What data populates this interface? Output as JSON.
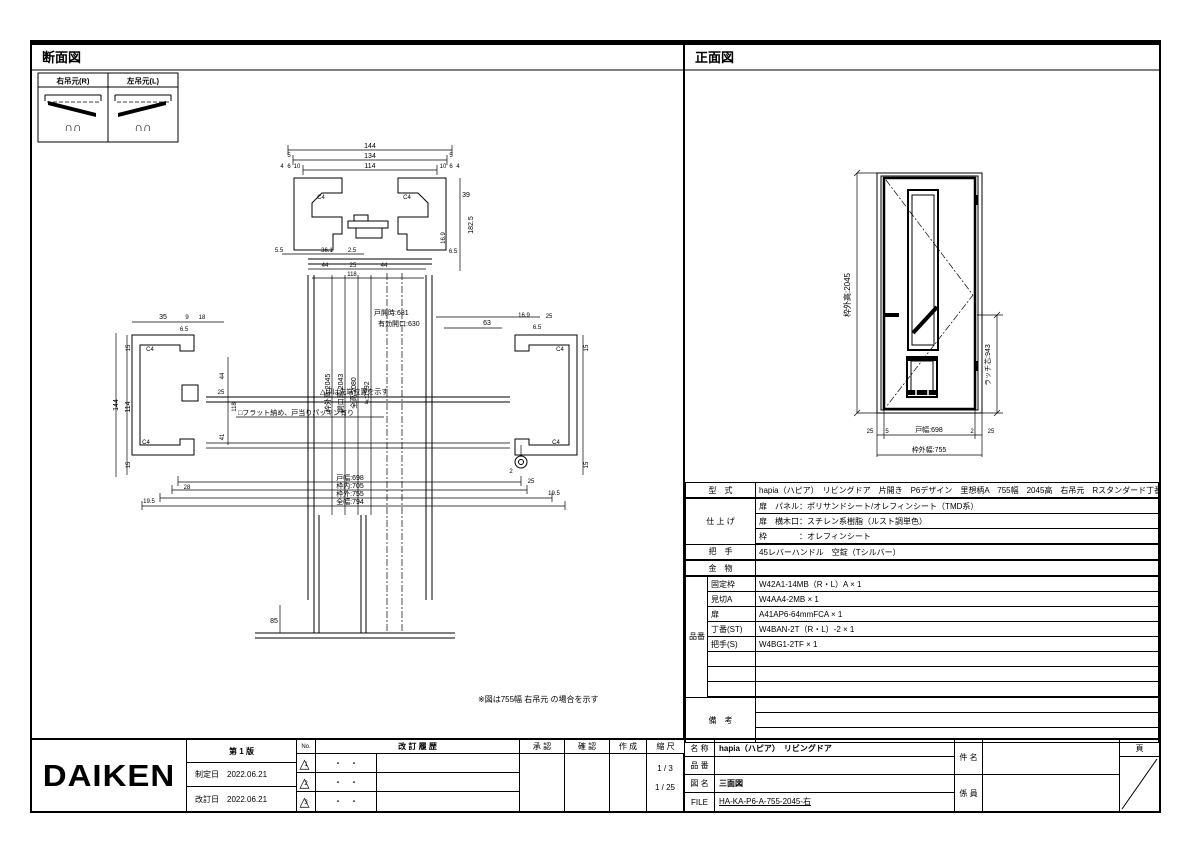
{
  "sheet": {
    "bg": "#ffffff",
    "line_color": "#000000"
  },
  "left_panel": {
    "title": "断面図",
    "hinge_table": {
      "right": "右吊元(R)",
      "left": "左吊元(L)"
    },
    "labels": [
      "144",
      "134",
      "5",
      "5",
      "114",
      "4",
      "6",
      "10",
      "10",
      "6",
      "4",
      "C4",
      "C4",
      "39",
      "182.5",
      "16.9",
      "6.5",
      "5.5",
      "36.1",
      "2.5",
      "44",
      "25",
      "44",
      "118",
      "35",
      "9",
      "18",
      "6.5",
      "15",
      "144",
      "114",
      "15",
      "C4",
      "C4",
      "戸開時:681",
      "有効開口:630",
      "63",
      "16.9",
      "25",
      "6.5",
      "44",
      "25",
      "118",
      "41",
      "枠外高:2045",
      "開口高:2043",
      "全高:2080",
      "≒:1992",
      "△印は先端位置を示す",
      "□フラット納め、戸当りパッキン有り",
      "C4",
      "C4",
      "15",
      "15",
      "2",
      "25",
      "19.5",
      "28",
      "19.5",
      "戸幅:698",
      "枠内:705",
      "枠外:755",
      "全幅:794",
      "85"
    ],
    "note": "※図は755幅 右吊元 の場合を示す"
  },
  "right_panel": {
    "title": "正面図",
    "elevation": {
      "height": "枠外高:2045",
      "latch": "ラッチ芯:943",
      "w1": "25",
      "w2": "5",
      "w3": "戸幅:698",
      "w4": "2",
      "w5": "25",
      "outer_width": "枠外幅:755"
    },
    "spec": {
      "model_label": "型　式",
      "model_value": "hapia（ハピア）　リビングドア　片開き　P6デザイン　里想柄A　755幅　2045高　右吊元　Rスタンダード丁番",
      "finish_label": "仕 上 げ",
      "finish_rows": [
        "扉　パネル：ポリサンドシート/オレフィンシート（TMD系）",
        "扉　横木口：スチレン系樹脂（ルスト調単色）",
        "枠　　　　：オレフィンシート"
      ],
      "handle_label": "把　手",
      "handle_value": "45レバーハンドル　空錠（Tシルバー）",
      "hardware_label": "金　物",
      "hardware_value": "",
      "parts_label": "品番",
      "parts": [
        {
          "name": "固定枠",
          "value": "W42A1-14MB（R・L）A × 1"
        },
        {
          "name": "見切A",
          "value": "W4AA4-2MB × 1"
        },
        {
          "name": "扉",
          "value": "A41AP6-64mmFCA × 1"
        },
        {
          "name": "丁番(ST)",
          "value": "W4BAN-2T（R・L）-2 × 1"
        },
        {
          "name": "把手(S)",
          "value": "W4BG1-2TF × 1"
        }
      ],
      "remarks_label": "備　考"
    }
  },
  "title_block": {
    "logo": "DAIKEN",
    "edition": "第 1 版",
    "enact_label": "制定日",
    "enact_date": "2022.06.21",
    "revise_label": "改訂日",
    "revise_date": "2022.06.21",
    "no_label": "No.",
    "history_label": "改 訂 履 歴",
    "approve_label": "承 認",
    "check_label": "確 認",
    "create_label": "作 成",
    "scale_label": "縮 尺",
    "scale_1": "1 / 3",
    "scale_2": "1 / 25",
    "name_label": "名 称",
    "name_value": "hapia（ハピア）　リビングドア",
    "part_label": "品 番",
    "part_value": "",
    "dwg_label": "図 名",
    "dwg_value": "三面図",
    "file_label": "FILE",
    "file_value": "HA-KA-P6-A-755-2045-右",
    "project_label": "件 名",
    "staff_label": "係 員",
    "page_label": "頁",
    "revisions": [
      {
        "no": "1",
        "date": "・　・"
      },
      {
        "no": "2",
        "date": "・　・"
      },
      {
        "no": "3",
        "date": "・　・"
      }
    ]
  }
}
